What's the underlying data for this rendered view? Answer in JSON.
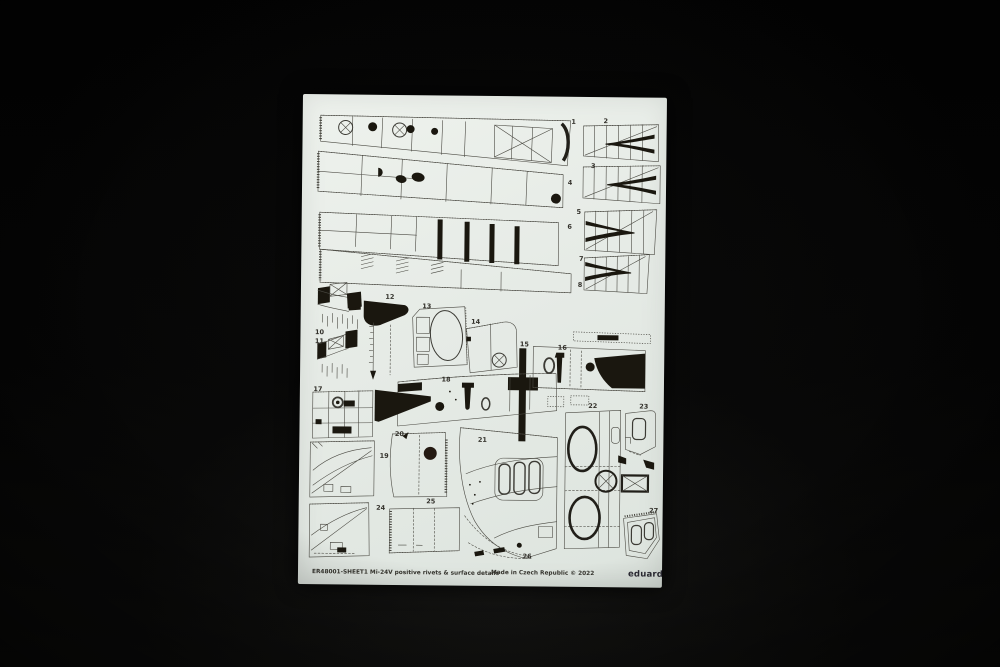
{
  "scene": {
    "background_color": "#040404",
    "sheet_color": "#e6ebe6",
    "print_line_color": "#4b4a43",
    "print_fill_color": "#1a170f"
  },
  "sheet": {
    "footer_left": "ER48001-SHEET1 Mi-24V positive rivets & surface details",
    "footer_center": "Made in Czech Republic © 2022",
    "brand_logo": "eduard"
  },
  "part_numbers": [
    "1",
    "2",
    "3",
    "4",
    "5",
    "6",
    "7",
    "8",
    "10",
    "11",
    "12",
    "13",
    "14",
    "15",
    "16",
    "17",
    "18",
    "19",
    "20",
    "21",
    "22",
    "23",
    "24",
    "25",
    "26",
    "27"
  ]
}
